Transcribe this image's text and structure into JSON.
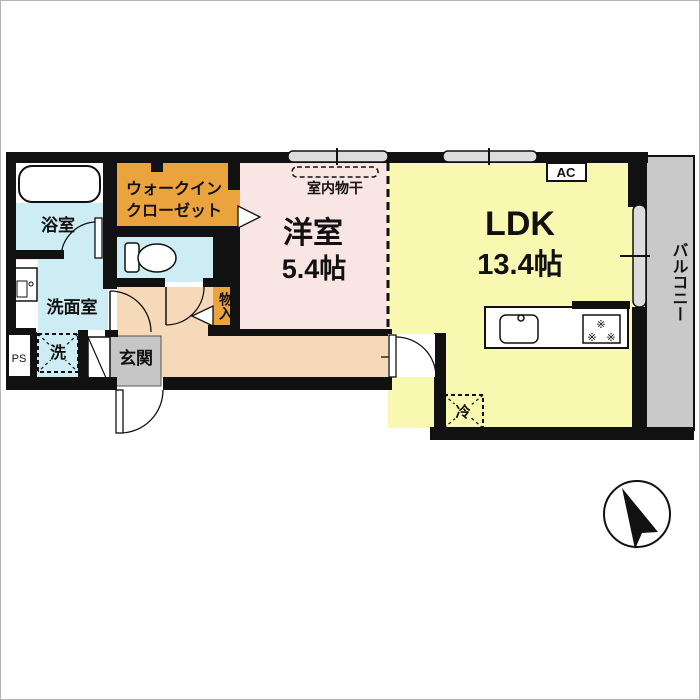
{
  "plan": {
    "rooms": {
      "bath": {
        "label": "浴室"
      },
      "walk_in_closet": {
        "label_line1": "ウォークイン",
        "label_line2": "クローゼット"
      },
      "washroom": {
        "label": "洗面室"
      },
      "washer_space": {
        "label": "洗"
      },
      "pipe_space": {
        "label": "PS"
      },
      "entrance": {
        "label": "玄関"
      },
      "storage": {
        "label": "物入"
      },
      "western_room": {
        "name": "洋室",
        "size": "5.4帖"
      },
      "ldk": {
        "name": "LDK",
        "size": "13.4帖"
      },
      "balcony": {
        "label": "バルコニー"
      }
    },
    "equipment": {
      "indoor_drying": {
        "label": "室内物干"
      },
      "air_conditioner": {
        "label": "AC"
      },
      "refrigerator": {
        "label": "冷"
      },
      "stove_burner": {
        "symbol": "※"
      }
    },
    "colors": {
      "wall": "#111111",
      "water_rooms_blue": "#cdecf3",
      "closet_orange": "#eba33e",
      "western_room_pink": "#f9e5e4",
      "ldk_yellow": "#f9f8b0",
      "hall_peach": "#f6d9b9",
      "entrance_gray": "#c6c6c6",
      "balcony_gray": "#c9c9c9",
      "window_fill": "#dcdcdc"
    }
  }
}
